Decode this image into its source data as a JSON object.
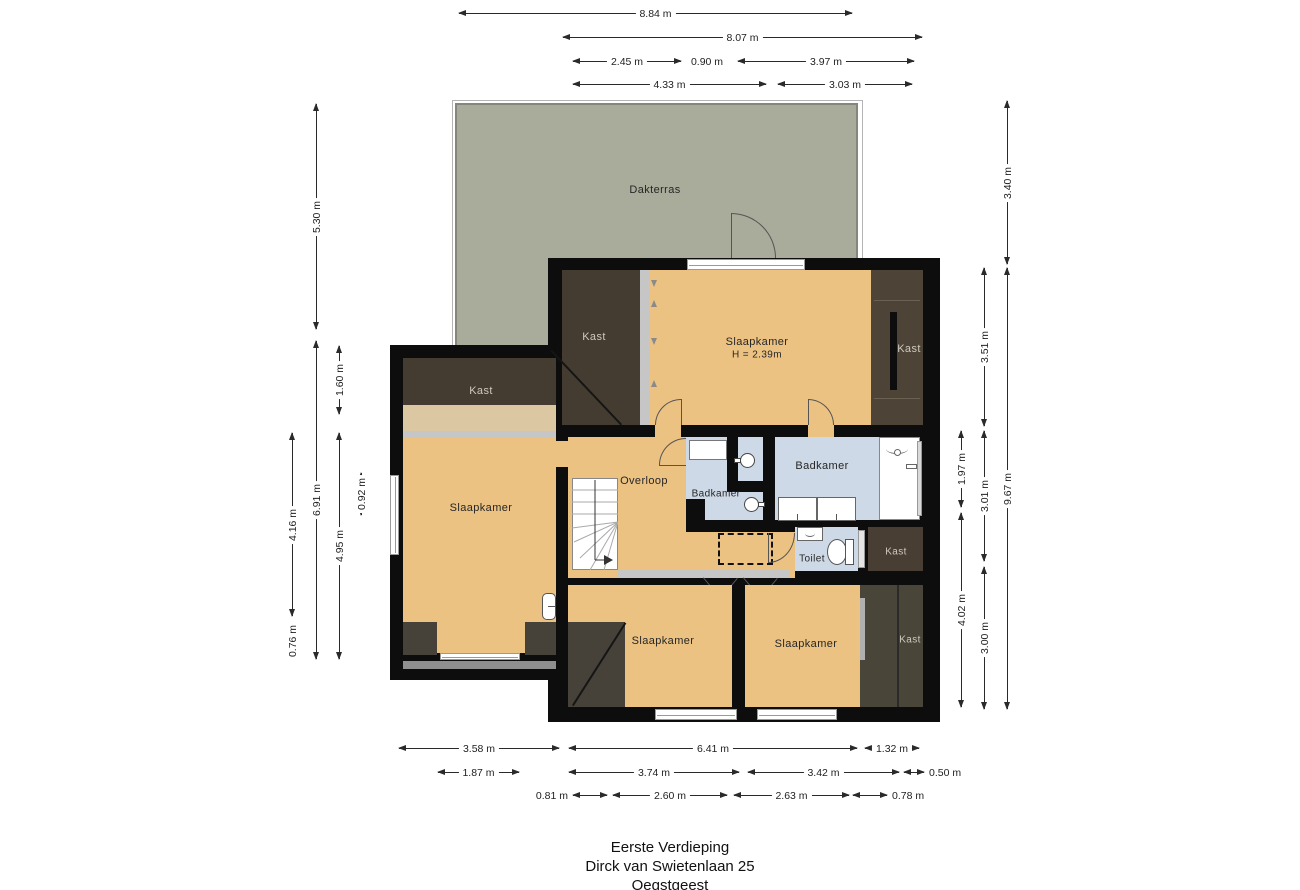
{
  "title_block": {
    "line1": "Eerste Verdieping",
    "line2": "Dirck van Swietenlaan 25",
    "line3": "Oegstgeest"
  },
  "rooms": {
    "dakterras": "Dakterras",
    "kast": "Kast",
    "slaapkamer": "Slaapkamer",
    "slaapkamer_height": "H = 2.39m",
    "overloop": "Overloop",
    "badkamer": "Badkamer",
    "toilet": "Toilet"
  },
  "dimensions": {
    "top": [
      "8.84 m",
      "8.07 m",
      "2.45 m",
      "0.90 m",
      "3.97 m",
      "4.33 m",
      "3.03 m"
    ],
    "bottom": [
      "3.58 m",
      "6.41 m",
      "1.32 m",
      "1.87 m",
      "3.74 m",
      "3.42 m",
      "0.50 m",
      "0.81 m",
      "2.60 m",
      "2.63 m",
      "0.78 m"
    ],
    "left": [
      "5.30 m",
      "1.60 m",
      "6.91 m",
      "4.16 m",
      "4.95 m",
      "0.92 m",
      "0.76 m"
    ],
    "right": [
      "3.40 m",
      "3.51 m",
      "1.97 m",
      "3.01 m",
      "9.67 m",
      "4.02 m",
      "3.00 m"
    ]
  },
  "colors": {
    "terrace": "#a9ac9a",
    "floor_orange": "#ecc283",
    "floor_tan": "#dcc7a3",
    "bathroom_blue": "#cdd9e6",
    "closet_dark": "#453c31",
    "wall_black": "#0d0d0d",
    "dim_text": "#2a2a2a"
  }
}
